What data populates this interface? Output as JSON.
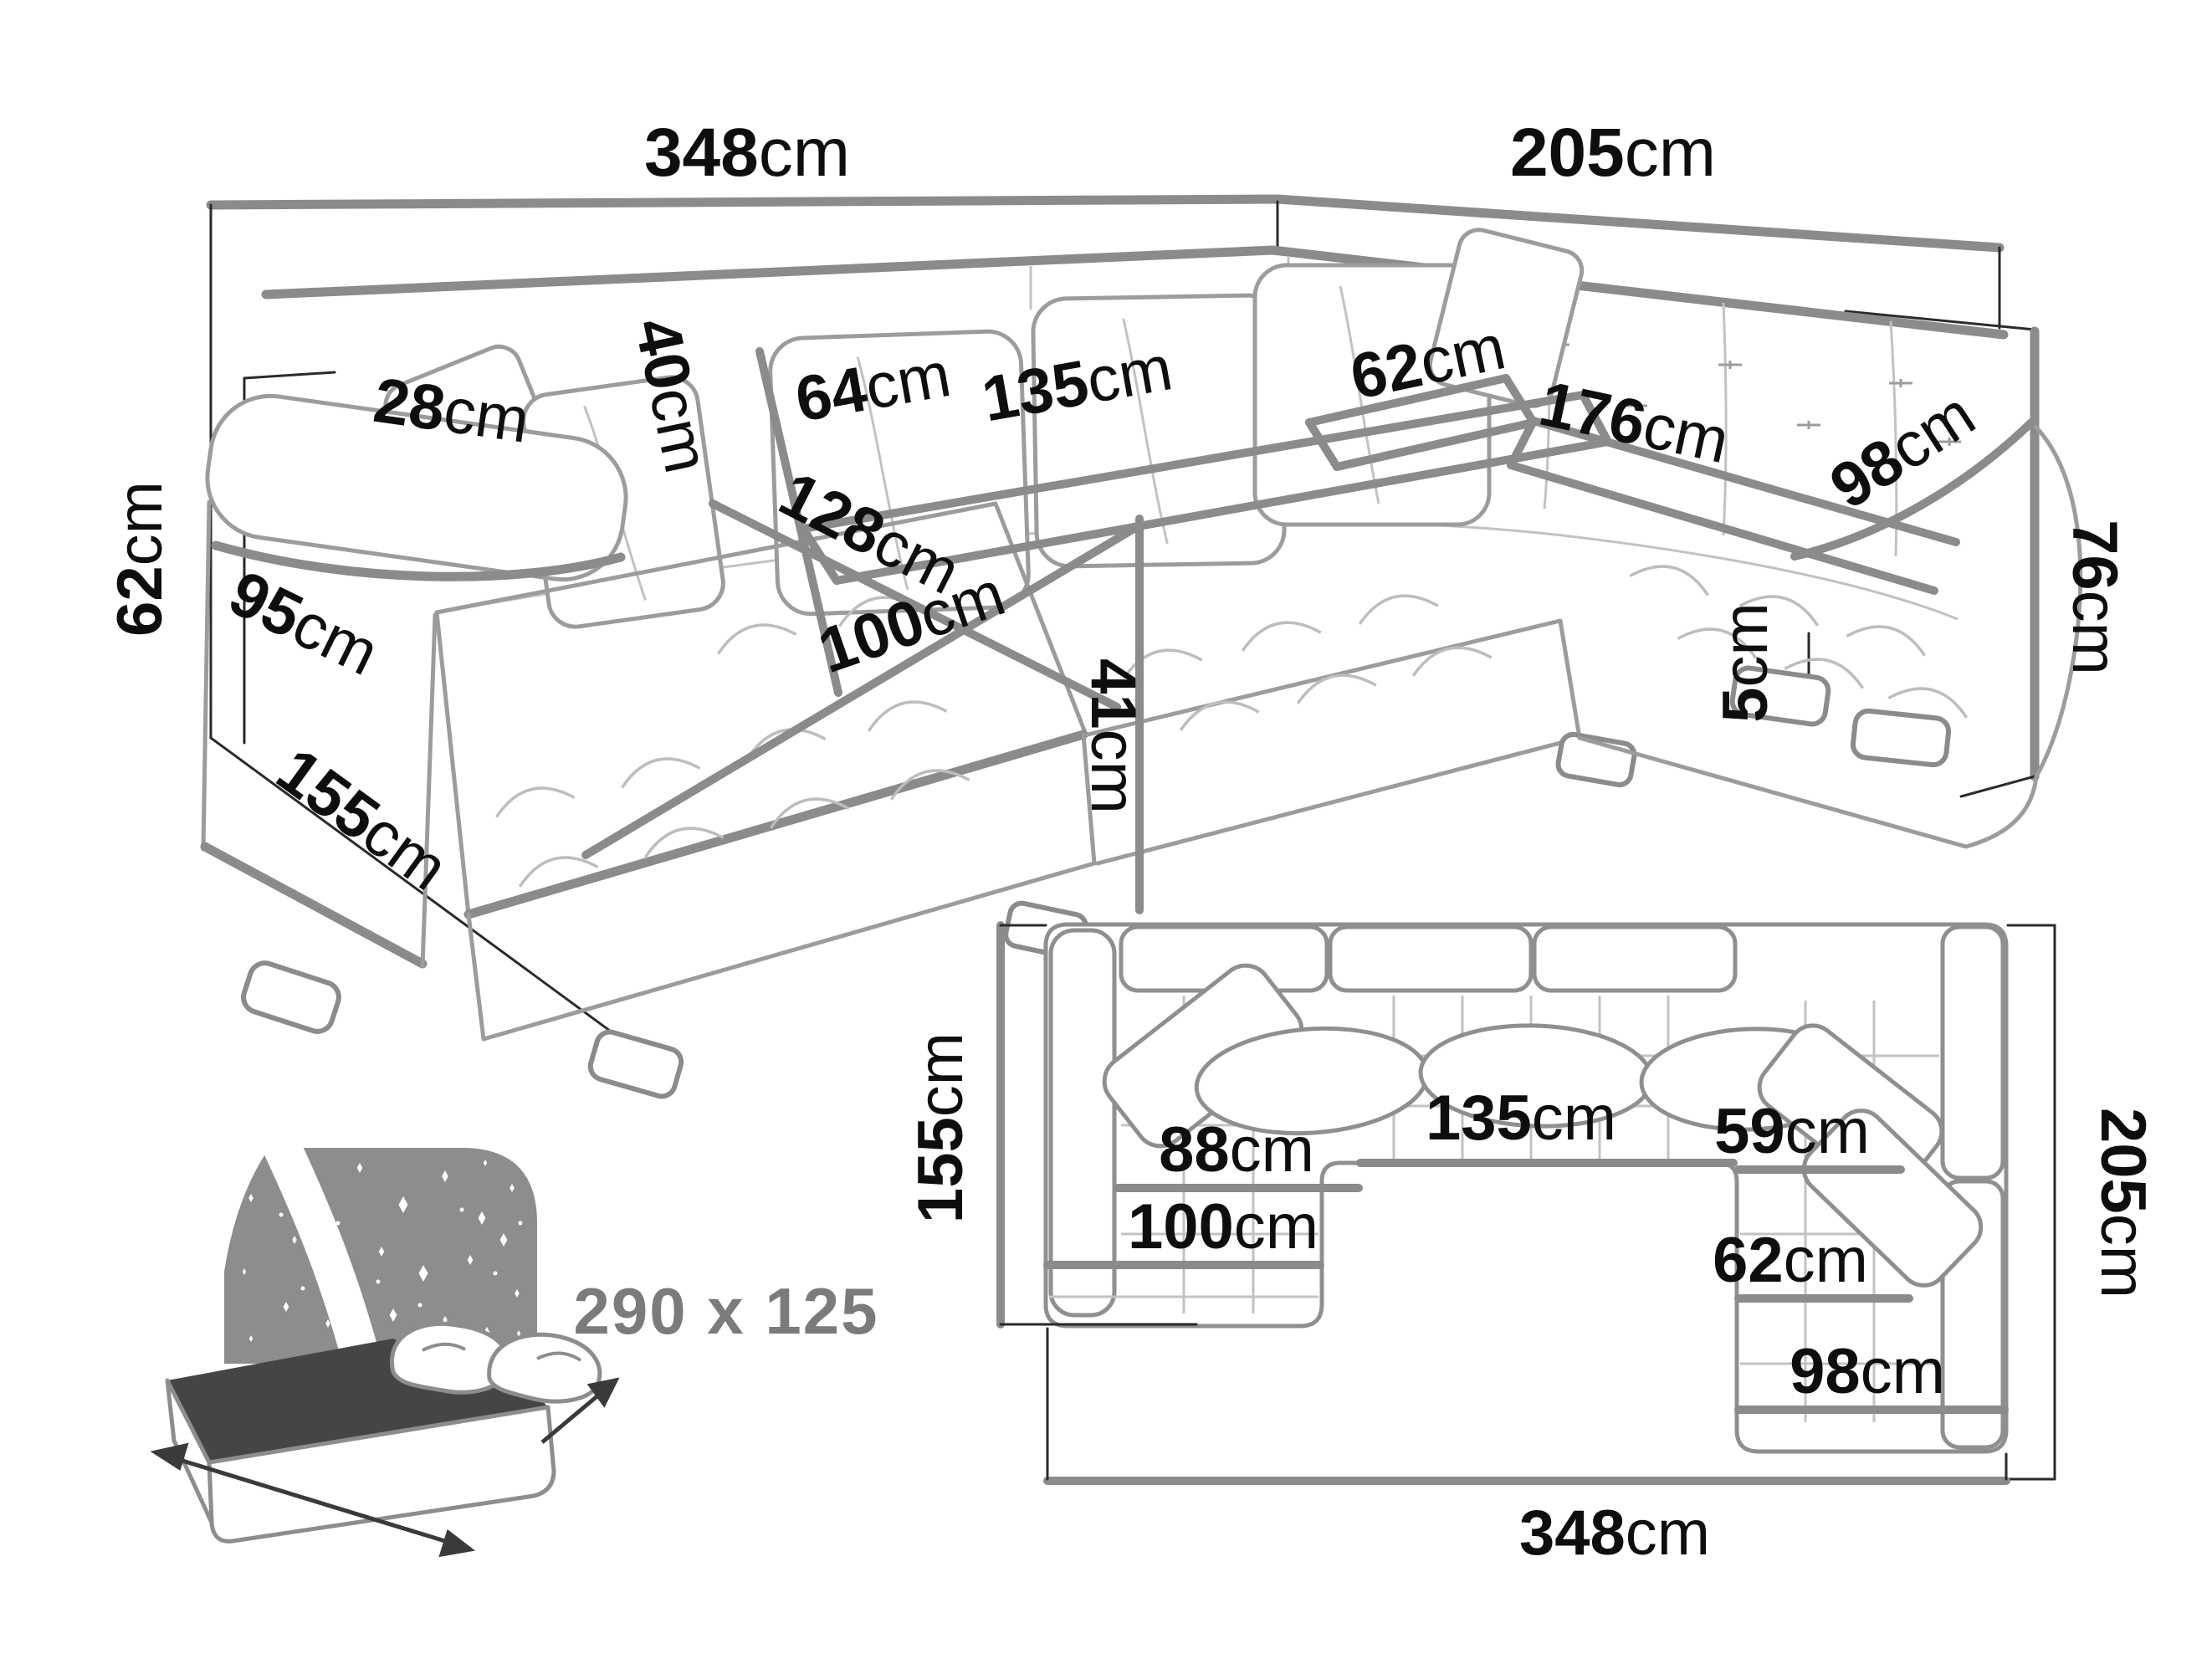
{
  "diagram": {
    "background": "#ffffff",
    "dimension_line_color": "#8b8b8b",
    "sketch_color": "#9c9c9c",
    "label_color": "#0e0e0e",
    "bed_icon_color": "#8d8d8d",
    "bed_text_color": "#7b7b7b"
  },
  "perspective_view": {
    "dimensions": {
      "total_width": {
        "value": "348",
        "unit": "cm"
      },
      "right_section_depth": {
        "value": "205",
        "unit": "cm"
      },
      "backrest_height": {
        "value": "76",
        "unit": "cm"
      },
      "side_height": {
        "value": "62",
        "unit": "cm"
      },
      "arm_side_depth": {
        "value": "95",
        "unit": "cm"
      },
      "arm_width": {
        "value": "28",
        "unit": "cm"
      },
      "chaise_side_depth": {
        "value": "155",
        "unit": "cm"
      },
      "back_cushion_height": {
        "value": "40",
        "unit": "cm"
      },
      "middle_seat_depth": {
        "value": "64",
        "unit": "cm"
      },
      "middle_seat_width": {
        "value": "135",
        "unit": "cm"
      },
      "chaise_length": {
        "value": "128",
        "unit": "cm"
      },
      "corner_seat_width": {
        "value": "62",
        "unit": "cm"
      },
      "right_seat_length": {
        "value": "176",
        "unit": "cm"
      },
      "right_seat_width": {
        "value": "98",
        "unit": "cm"
      },
      "chaise_width": {
        "value": "100",
        "unit": "cm"
      },
      "seat_height": {
        "value": "41",
        "unit": "cm"
      },
      "leg_height": {
        "value": "5",
        "unit": "cm"
      }
    }
  },
  "plan_view": {
    "dimensions": {
      "total_width": {
        "value": "348",
        "unit": "cm"
      },
      "right_depth": {
        "value": "205",
        "unit": "cm"
      },
      "left_depth": {
        "value": "155",
        "unit": "cm"
      },
      "left_seat_width": {
        "value": "88",
        "unit": "cm"
      },
      "middle_seat_width": {
        "value": "135",
        "unit": "cm"
      },
      "right_seat_top_width": {
        "value": "59",
        "unit": "cm"
      },
      "right_seat_width": {
        "value": "62",
        "unit": "cm"
      },
      "chaise_width": {
        "value": "100",
        "unit": "cm"
      },
      "right_arm_width": {
        "value": "98",
        "unit": "cm"
      }
    }
  },
  "sleeping_function": {
    "label": "290 x 125"
  }
}
